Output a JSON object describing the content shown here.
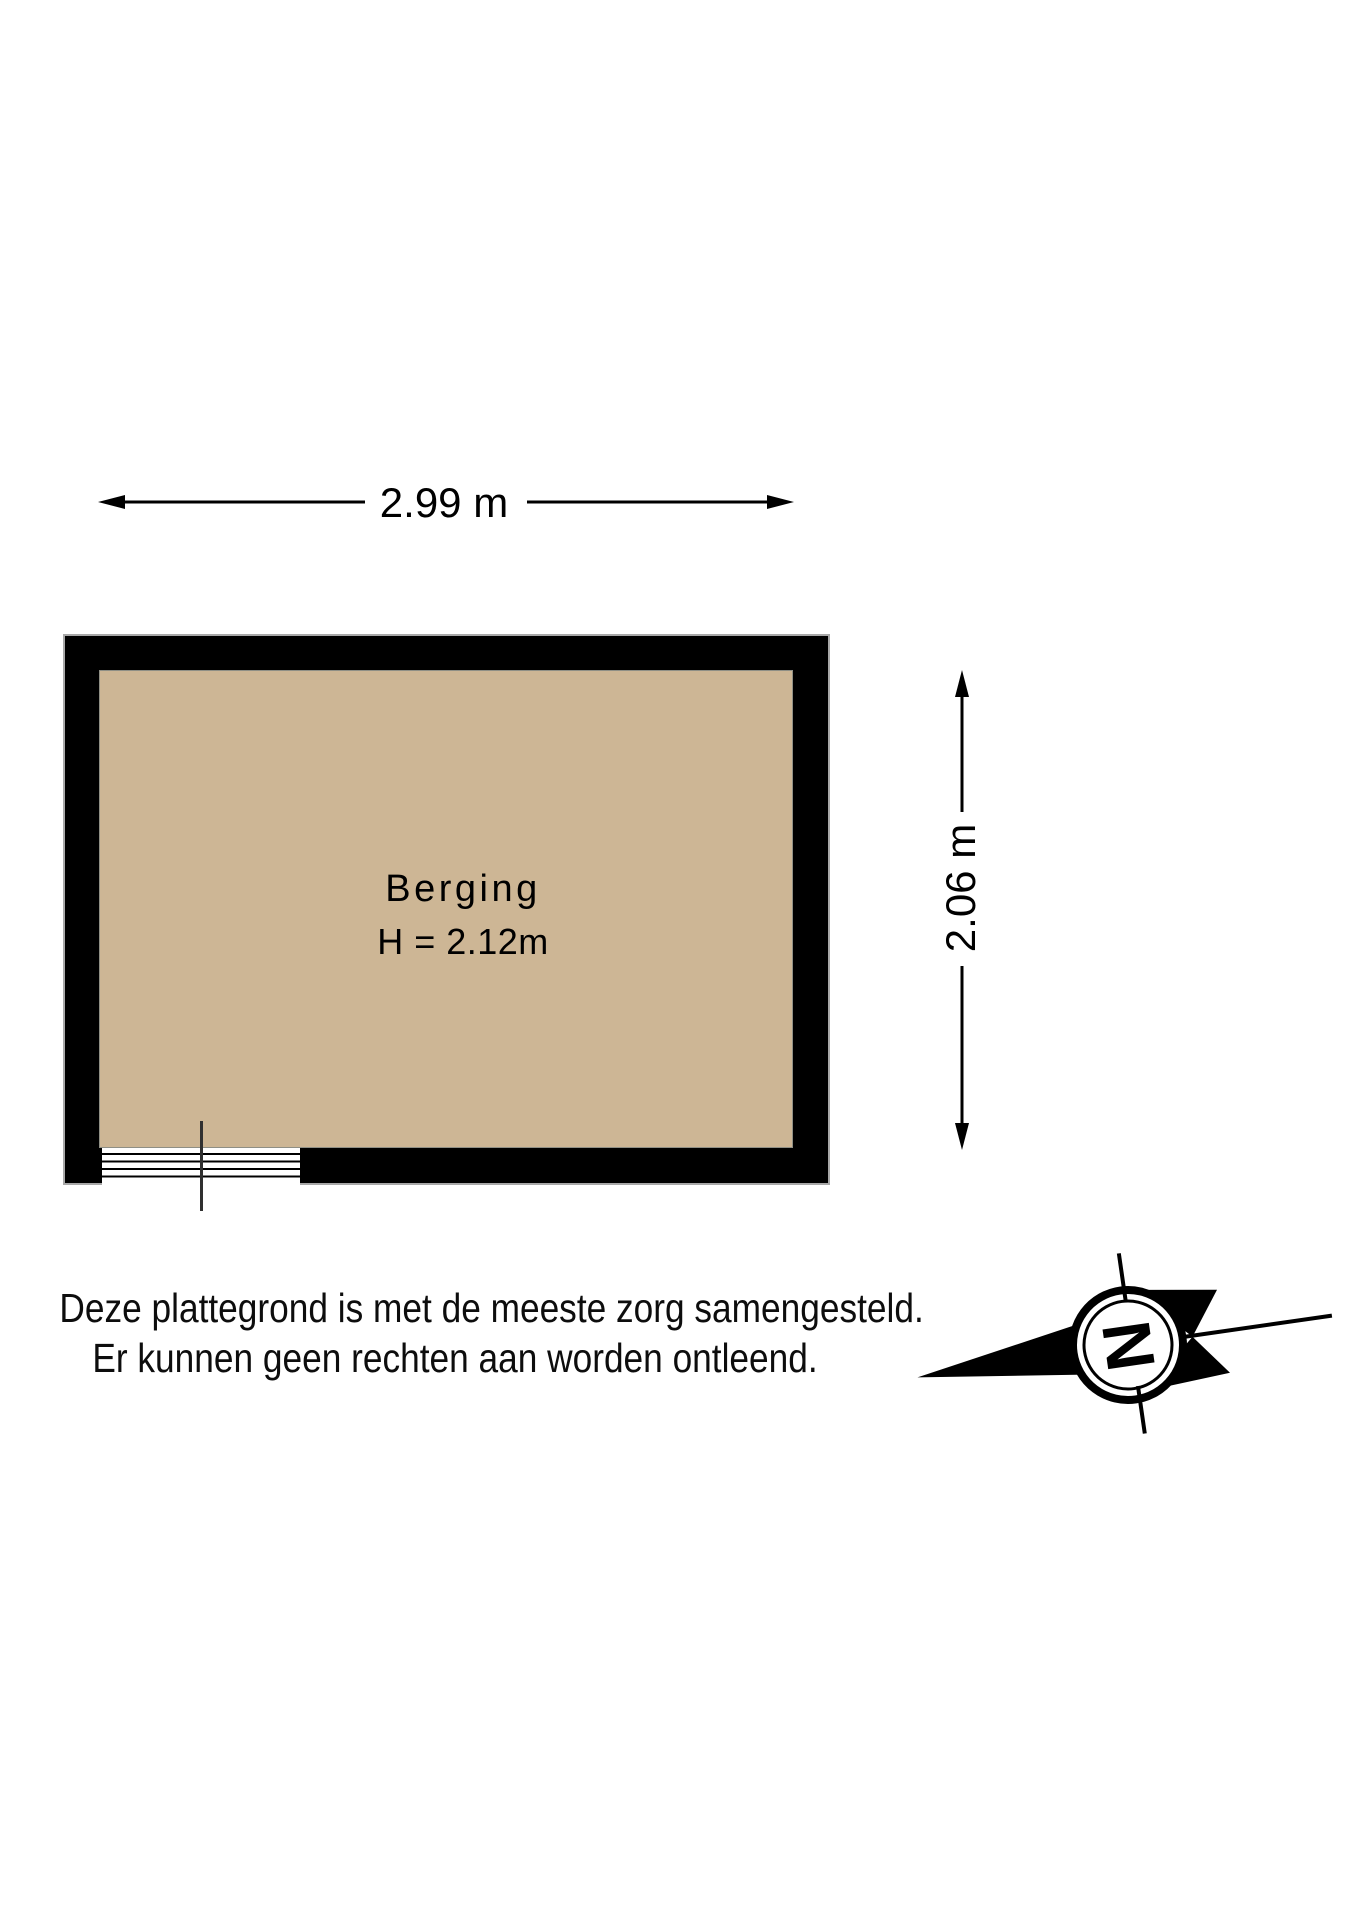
{
  "plan": {
    "dimensions": {
      "width_label": "2.99 m",
      "height_label": "2.06 m"
    },
    "room": {
      "name": "Berging",
      "ceiling_height_label": "H = 2.12m"
    },
    "disclaimer": {
      "line1": "Deze plattegrond is met de meeste zorg samengesteld.",
      "line2": "Er kunnen geen rechten aan worden ontleend."
    },
    "compass": {
      "north_letter": "N"
    },
    "colors": {
      "wall": "#000000",
      "floor": "#CDB695",
      "wall_outline": "#A8A8A8"
    }
  }
}
